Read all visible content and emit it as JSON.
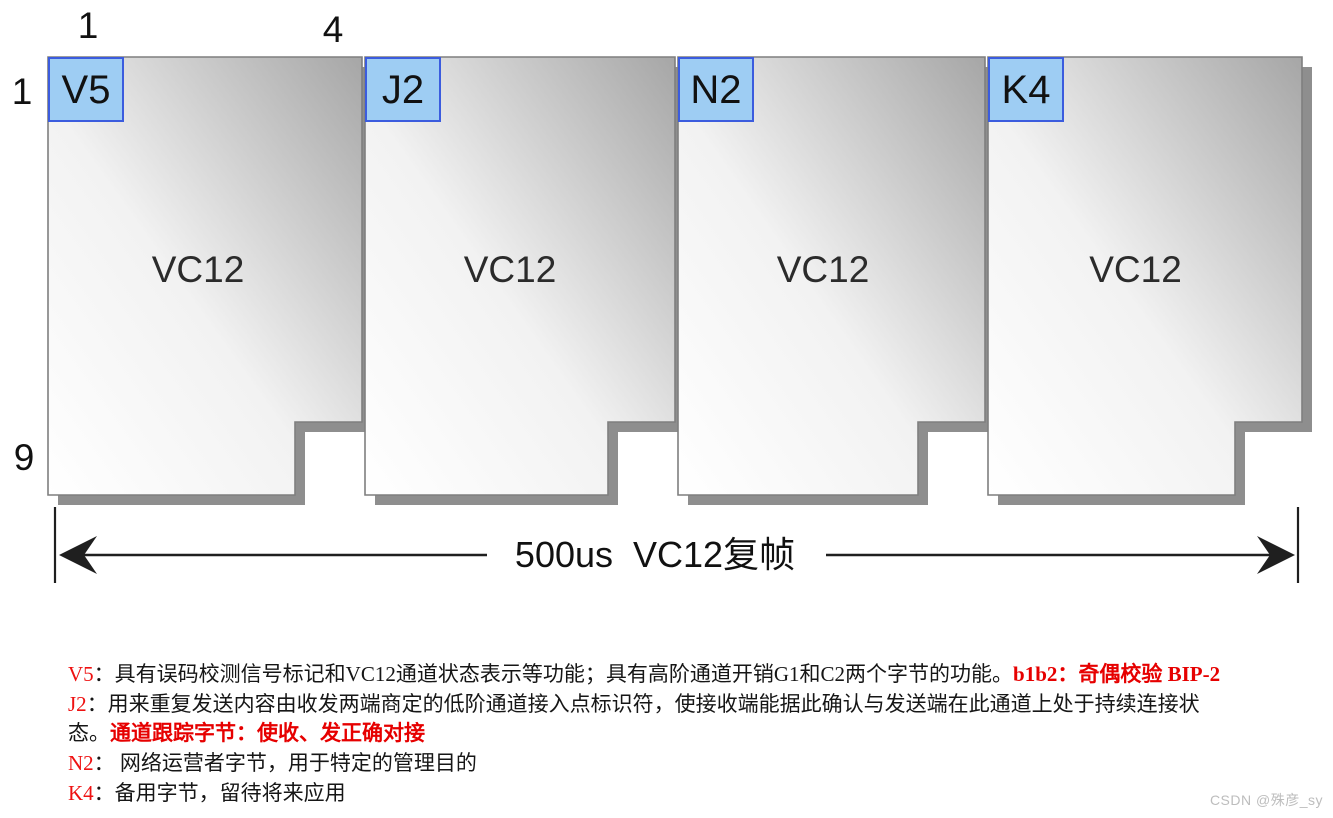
{
  "diagram": {
    "top_axis": {
      "col_start": "1",
      "col_end": "4"
    },
    "left_axis": {
      "row_start": "1",
      "row_end": "9"
    },
    "blocks": [
      {
        "byte": "V5",
        "label": "VC12"
      },
      {
        "byte": "J2",
        "label": "VC12"
      },
      {
        "byte": "N2",
        "label": "VC12"
      },
      {
        "byte": "K4",
        "label": "VC12"
      }
    ],
    "arrow_label": "500us  VC12复帧"
  },
  "notes": [
    {
      "prefix": "V5",
      "body": "：具有误码校测信号标记和VC12通道状态表示等功能；具有高阶通道开销G1和C2两个字节的功能。",
      "highlight": "b1b2：奇偶校验 BIP-2"
    },
    {
      "prefix": "J2",
      "body": "：用来重复发送内容由收发两端商定的低阶通道接入点标识符，使接收端能据此确认与发送端在此通道上处于持续连接状",
      "highlight": ""
    },
    {
      "prefix": "",
      "body": "态。",
      "highlight": "通道跟踪字节：使收、发正确对接"
    },
    {
      "prefix": "N2",
      "body": "： 网络运营者字节，用于特定的管理目的",
      "highlight": ""
    },
    {
      "prefix": "K4",
      "body": "：备用字节，留待将来应用",
      "highlight": ""
    }
  ],
  "watermark": "CSDN @殊彦_sy",
  "colors": {
    "byte_cell_fill": "#9ecdf3",
    "byte_cell_border": "#3b5cde",
    "block_gradient_dark": "#a6a6a6",
    "block_shadow": "#8e8e8e",
    "annotation_red": "#ee1111",
    "highlight_red": "#e60000",
    "watermark_gray": "#bdbdbd"
  }
}
